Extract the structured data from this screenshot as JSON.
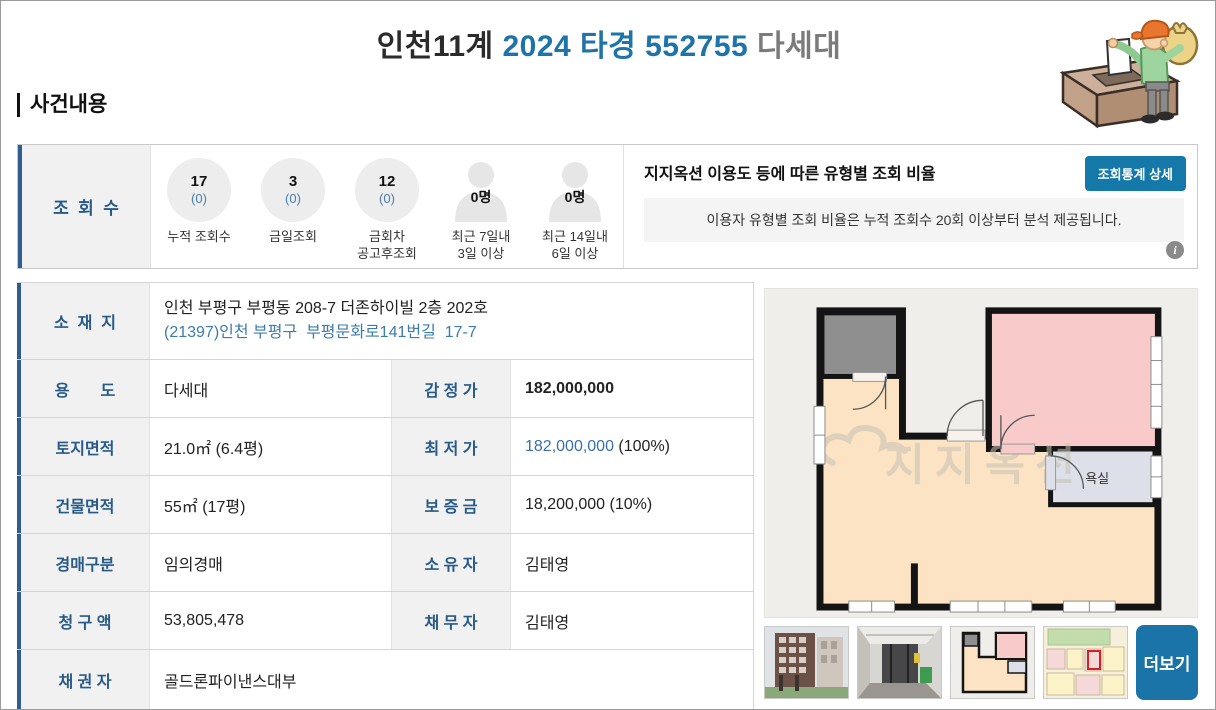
{
  "header": {
    "court": "인천11계",
    "case_no": "2024 타경 552755",
    "category": "다세대"
  },
  "section": {
    "title": "사건내용"
  },
  "stats": {
    "label": "조  회  수",
    "items": [
      {
        "type": "circle",
        "value": "17",
        "sub": "(0)",
        "caption": "누적 조회수"
      },
      {
        "type": "circle",
        "value": "3",
        "sub": "(0)",
        "caption": "금일조회"
      },
      {
        "type": "circle",
        "value": "12",
        "sub": "(0)",
        "caption": "금회차\n공고후조회"
      },
      {
        "type": "person",
        "value": "0명",
        "caption": "최근 7일내\n3일 이상"
      },
      {
        "type": "person",
        "value": "0명",
        "caption": "최근 14일내\n6일 이상"
      }
    ],
    "panel": {
      "title": "지지옥션 이용도 등에 따른 유형별 조회 비율",
      "button_label": "조회통계 상세",
      "notice": "이용자 유형별 조회 비율은 누적 조회수 20회 이상부터 분석 제공됩니다.",
      "info_glyph": "i"
    }
  },
  "details": {
    "address": {
      "label": "소  재  지",
      "line1": "인천 부평구 부평동 208-7 더존하이빌 2층 202호",
      "line2": "(21397)인천 부평구  부평문화로141번길  17-7"
    },
    "rows": [
      {
        "l1": "용       도",
        "v1": "다세대",
        "l2": "감 정 가",
        "v2": "182,000,000"
      },
      {
        "l1": "토지면적",
        "v1": "21.0㎡ (6.4평)",
        "l2": "최 저 가",
        "v2_num": "182,000,000",
        "v2_suffix": " (100%)"
      },
      {
        "l1": "건물면적",
        "v1": "55㎡ (17평)",
        "l2": "보 증 금",
        "v2": "18,200,000 (10%)"
      },
      {
        "l1": "경매구분",
        "v1": "임의경매",
        "l2": "소 유 자",
        "v2": "김태영"
      },
      {
        "l1": "청 구 액",
        "v1": "53,805,478",
        "l2": "채 무 자",
        "v2": "김태영"
      },
      {
        "l1": "채 권 자",
        "v1": "골드론파이낸스대부"
      }
    ]
  },
  "media": {
    "floorplan": {
      "bathroom_label": "욕실",
      "watermark": "지지옥션"
    },
    "thumbnails": [
      {
        "name": "building-photo"
      },
      {
        "name": "entrance-photo"
      },
      {
        "name": "floorplan-thumb"
      },
      {
        "name": "cadastral-map-thumb"
      }
    ],
    "more_label": "더보기"
  },
  "colors": {
    "title_blue": "#1e74a8",
    "label_navy": "#285a88",
    "left_bar_navy": "#2f5d8f",
    "button_blue": "#1478a8",
    "more_button_blue": "#1a74a8",
    "link_blue": "#3c7cad",
    "min_price_blue": "#3a6fa8",
    "label_bg": "#f1f1f1"
  }
}
